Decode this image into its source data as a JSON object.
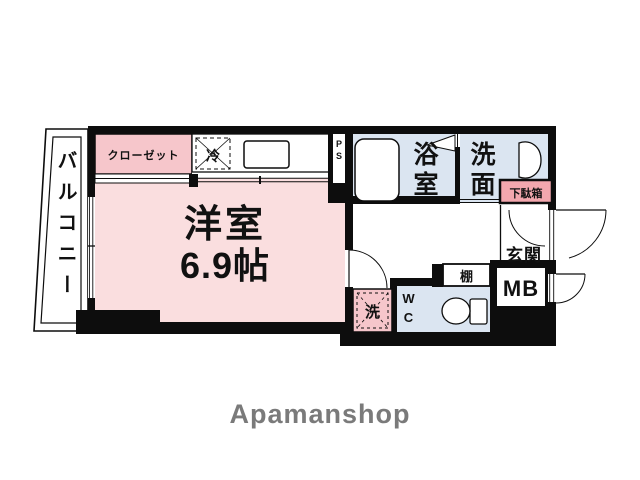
{
  "colors": {
    "wall": "#0d0d0d",
    "room_pink": "#fadedf",
    "fixture_pink": "#f6c6cb",
    "label_pink": "#f3a7ae",
    "wet_blue": "#dbe5f1",
    "logo_gray": "#7a7a7a"
  },
  "floorplan": {
    "balcony": "バルコニー",
    "closet": "クローゼット",
    "fridge": "冷",
    "pipe_space": "PS",
    "room_name": "洋室",
    "room_size": "6.9帖",
    "bathroom": "浴室",
    "washroom": "洗面",
    "shoe_box": "下駄箱",
    "entrance": "玄関",
    "meter_box": "MB",
    "shelf": "棚",
    "toilet": "WC",
    "washer": "洗"
  },
  "footer": {
    "brand": "Apamanshop"
  }
}
